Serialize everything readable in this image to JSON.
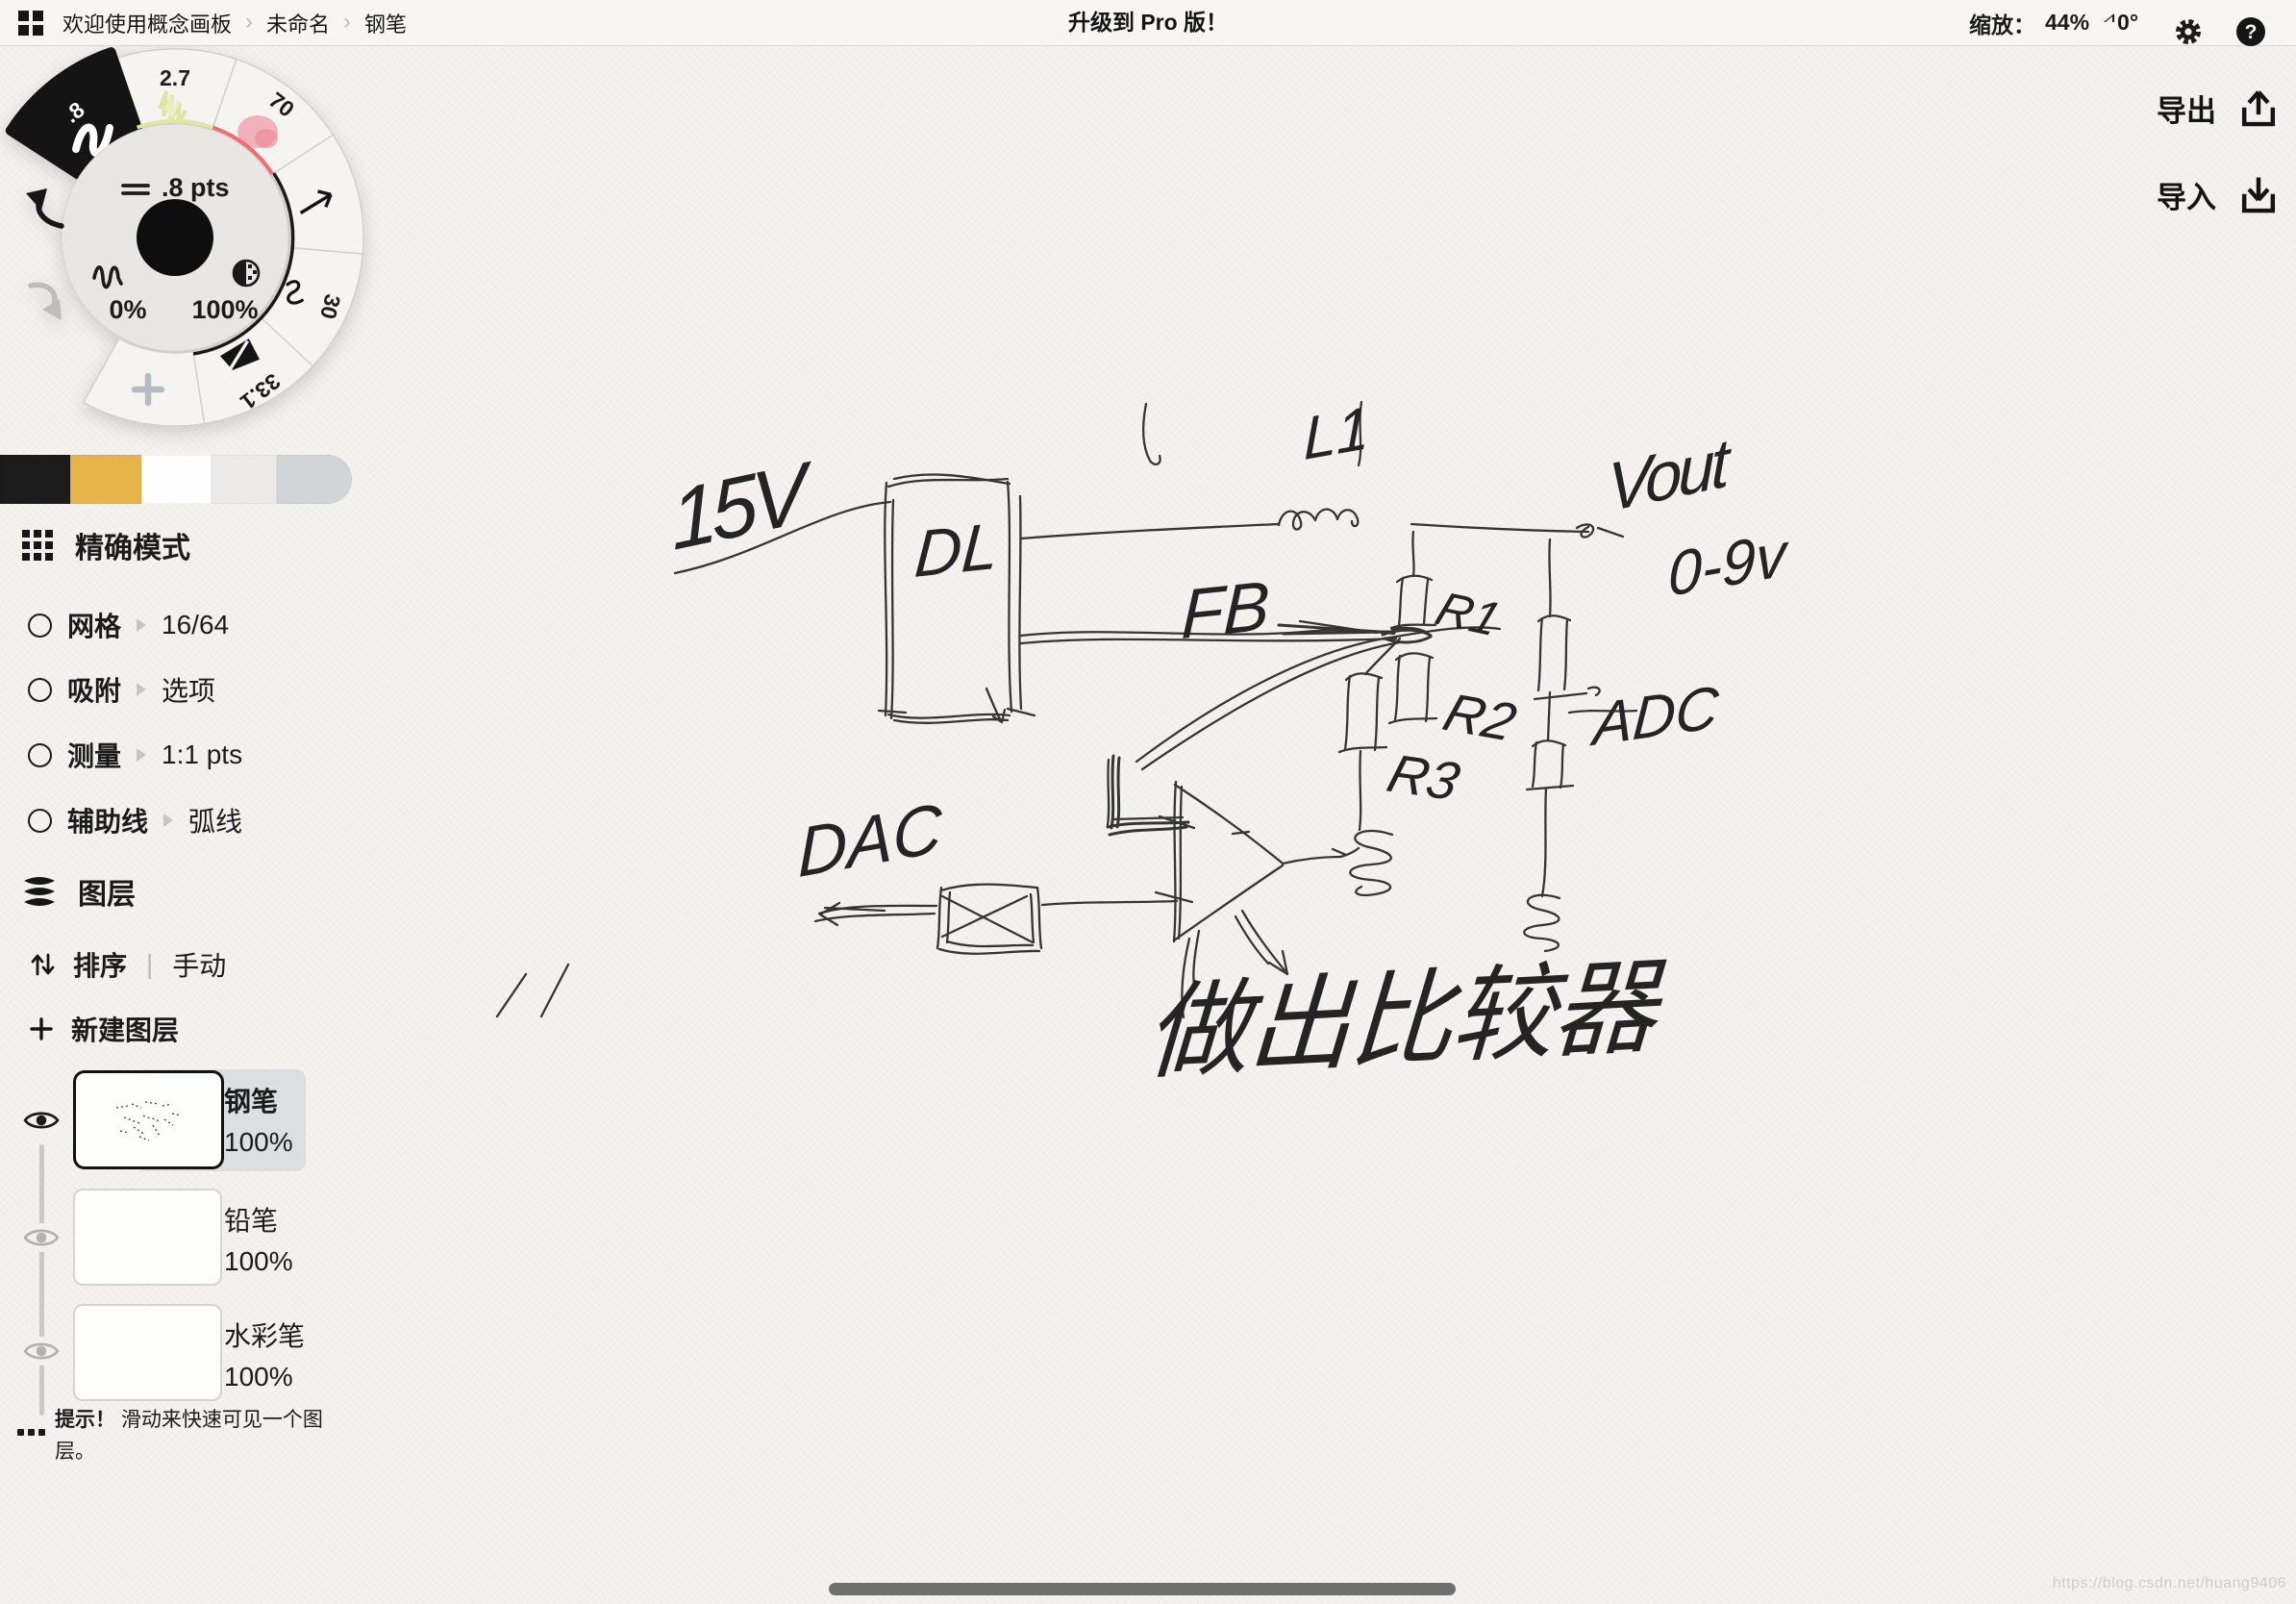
{
  "topbar": {
    "breadcrumb": [
      "欢迎使用概念画板",
      "未命名",
      "钢笔"
    ],
    "title": "升级到 Pro 版！",
    "zoom_label": "缩放：",
    "zoom_value": "44%",
    "angle_value": "0°"
  },
  "actions": {
    "export_label": "导出",
    "import_label": "导入"
  },
  "tool_wheel": {
    "stroke_width_label": ".8 pts",
    "smoothing_value": "0%",
    "opacity_value": "100%",
    "segment_values": {
      "pen": ".8",
      "pencil": "2.7",
      "soft_pastel": "70",
      "wire": "30",
      "slice": "33.1"
    },
    "accent_colors": {
      "selected": "#141414",
      "pencil_arc": "#dfe89e",
      "pastel_arc": "#ee6e74",
      "active_arc": "#1a1a1a"
    }
  },
  "swatches": [
    "#1b1b1b",
    "#e7b44b",
    "#fdfdfd",
    "#ebeae8",
    "#d2d5d7"
  ],
  "precision": {
    "title": "精确模式",
    "items": [
      {
        "label": "网格",
        "value": "16/64"
      },
      {
        "label": "吸附",
        "value": "选项"
      },
      {
        "label": "测量",
        "value": "1:1 pts"
      },
      {
        "label": "辅助线",
        "value": "弧线"
      }
    ]
  },
  "layers_panel": {
    "title": "图层",
    "sort_label": "排序",
    "sort_mode": "手动",
    "new_layer_label": "新建图层",
    "layers": [
      {
        "name": "钢笔",
        "opacity": "100%"
      },
      {
        "name": "铅笔",
        "opacity": "100%"
      },
      {
        "name": "水彩笔",
        "opacity": "100%"
      }
    ],
    "tip_bold": "提示！",
    "tip_text": "滑动来快速可见一个图层。"
  },
  "sketch_labels": {
    "supply": "15V",
    "regulator": "DL",
    "inductor": "L1",
    "feedback": "FB",
    "r1": "R1",
    "r2": "R2",
    "r3": "R3",
    "vout": "Vout",
    "vout_range": "0-9v",
    "adc": "ADC",
    "dac": "DAC",
    "annotation": "做出比较器"
  },
  "watermark": "https://blog.csdn.net/huang9406"
}
